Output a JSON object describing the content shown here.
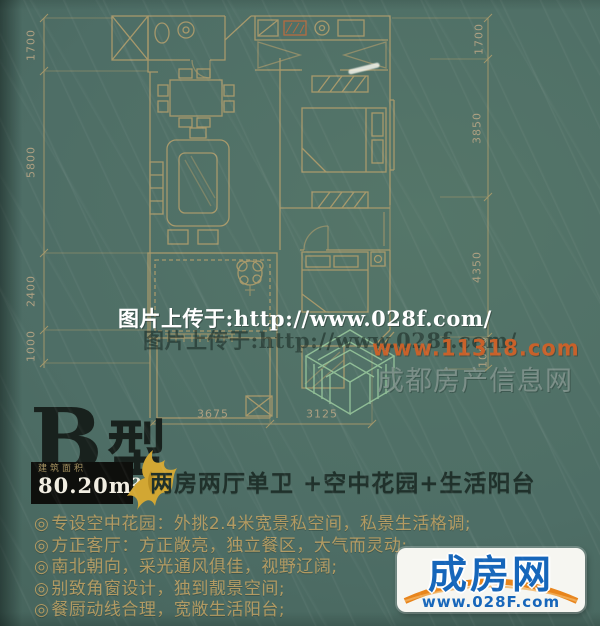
{
  "colors": {
    "background": "#4e6e66",
    "plan_line": "#b7a06c",
    "accent_orange": "#c8612a",
    "gold_text": "#b29a62",
    "brand_blue": "#1666ba",
    "brand_orange": "#e8851c"
  },
  "floorplan": {
    "dims_left": [
      "1700",
      "5800",
      "2400",
      "1000"
    ],
    "dims_right": [
      "1700",
      "3850",
      "4350",
      "1000"
    ],
    "dims_bottom": [
      "3675",
      "3125"
    ]
  },
  "watermarks": {
    "upload_line": "图片上传于:http://www.028f.com/",
    "upload_line_shadow": "图片上传于:http://www.028f.com/",
    "orange_url": "www.11318.com",
    "site_name": "成都房产信息网"
  },
  "unit_info": {
    "type_letter": "B",
    "type_char": "型",
    "area_caption": "建筑面积",
    "area_value": "80.20m²",
    "summary": "两房两厅单卫 +空中花园+生活阳台"
  },
  "features": [
    {
      "bullet": "◎",
      "text": "专设空中花园：外挑2.4米宽景私空间，私景生活格调;"
    },
    {
      "bullet": "◎",
      "text": "方正客厅：方正敞亮，独立餐区，大气而灵动;"
    },
    {
      "bullet": "◎",
      "text": "南北朝向，采光通风俱佳，视野辽阔;"
    },
    {
      "bullet": "◎",
      "text": "别致角窗设计，独到靓景空间;"
    },
    {
      "bullet": "◎",
      "text": "餐厨动线合理，宽敞生活阳台;"
    }
  ],
  "brand": {
    "name": "成房网",
    "url": "www.028F.com"
  }
}
